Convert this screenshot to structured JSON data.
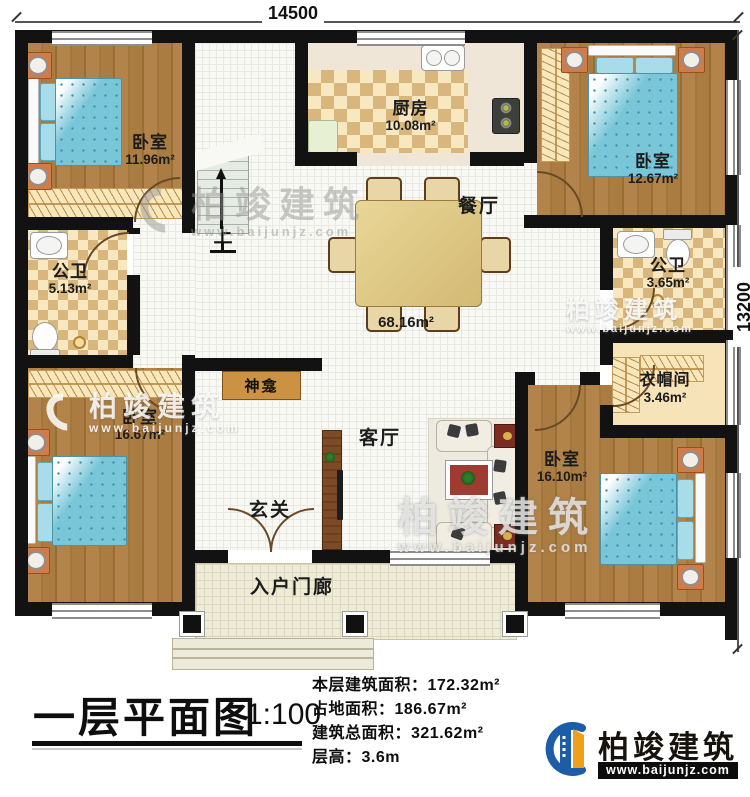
{
  "dimensions": {
    "top": "14500",
    "right": "13200"
  },
  "watermark": {
    "brand": "柏竣建筑",
    "url": "www.baijunjz.com"
  },
  "plan": {
    "stairs_up": "上",
    "hall": {
      "area": "68.16m²"
    },
    "rooms": {
      "bedroom_tl": {
        "name": "卧室",
        "area": "11.96m²"
      },
      "bath_left": {
        "name": "公卫",
        "area": "5.13m²"
      },
      "bedroom_bl": {
        "name": "卧室",
        "area": "16.67m²"
      },
      "kitchen": {
        "name": "厨房",
        "area": "10.08m²"
      },
      "dining": {
        "name": "餐厅"
      },
      "bedroom_tr": {
        "name": "卧室",
        "area": "12.67m²"
      },
      "bath_right": {
        "name": "公卫",
        "area": "3.65m²"
      },
      "cloakroom": {
        "name": "衣帽间",
        "area": "3.46m²"
      },
      "bedroom_br": {
        "name": "卧室",
        "area": "16.10m²"
      },
      "shrine": {
        "name": "神龛"
      },
      "living": {
        "name": "客厅"
      },
      "foyer": {
        "name": "玄关"
      },
      "porch": {
        "name": "入户门廊"
      }
    }
  },
  "title_block": {
    "title": "一层平面图",
    "scale": "1:100",
    "stats": [
      "本层建筑面积：172.32m²",
      "占地面积：186.67m²",
      "建筑总面积：321.62m²",
      "层高：3.6m"
    ]
  },
  "logo": {
    "brand": "柏竣建筑",
    "url": "www.baijunjz.com",
    "blue": "#1d5ca6",
    "orange": "#f09f1a"
  }
}
